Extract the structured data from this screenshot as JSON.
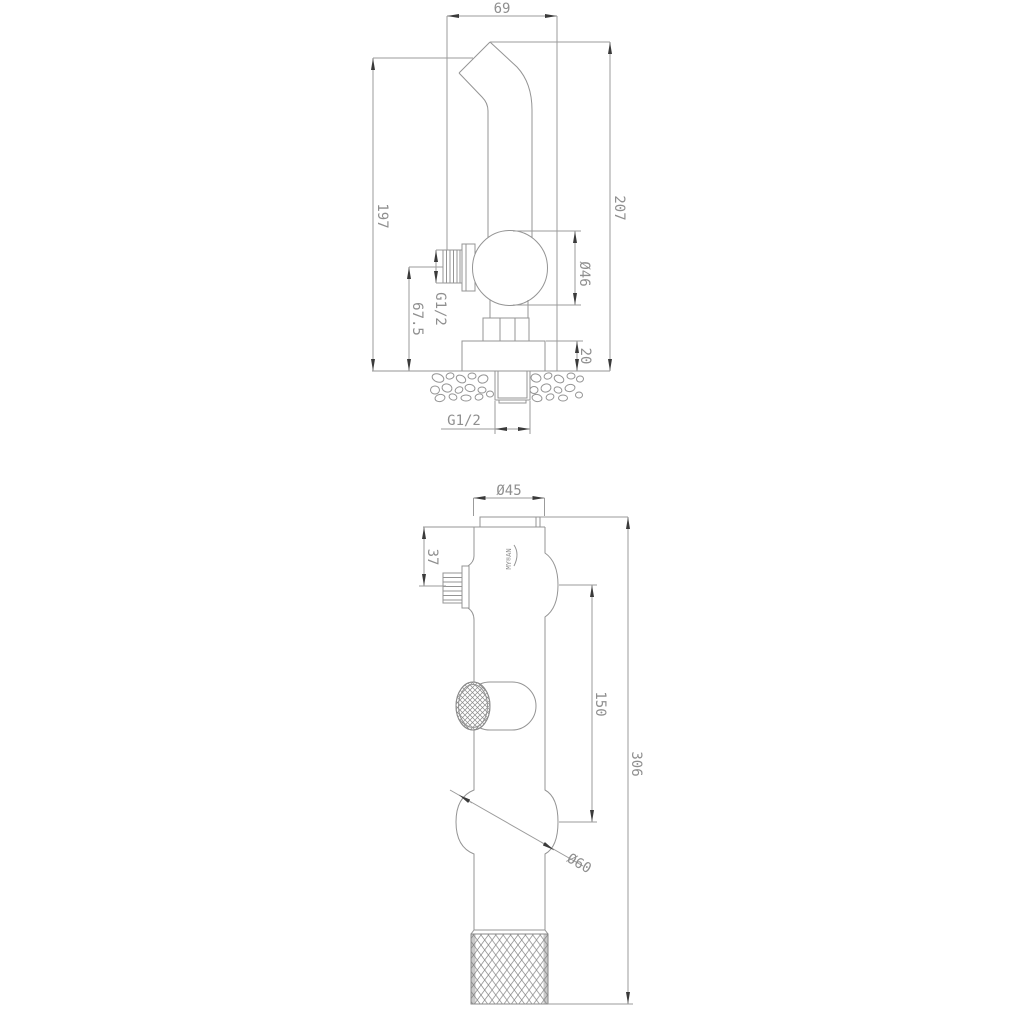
{
  "drawing": {
    "type": "technical-dimension-drawing",
    "subject": "bidet sprayer set - wall-mounted angle valve and hand sprayer",
    "colors": {
      "background": "#ffffff",
      "line": "#949494",
      "text": "#8f8f8f",
      "arrow": "#3a3a3a"
    },
    "view1": {
      "name": "wall-mounted angle valve side view",
      "width_69": "69",
      "height_197": "197",
      "height_207": "207",
      "dia_46": "Ø46",
      "thread_inlet": "G1/2",
      "height_67_5": "67.5",
      "plate_20": "20",
      "thread_wall": "G1/2"
    },
    "view2": {
      "name": "hand sprayer side view",
      "dia_45": "Ø45",
      "offset_37": "37",
      "span_150": "150",
      "length_306": "306",
      "dia_60": "Ø60",
      "logo": "MY®AN"
    }
  }
}
